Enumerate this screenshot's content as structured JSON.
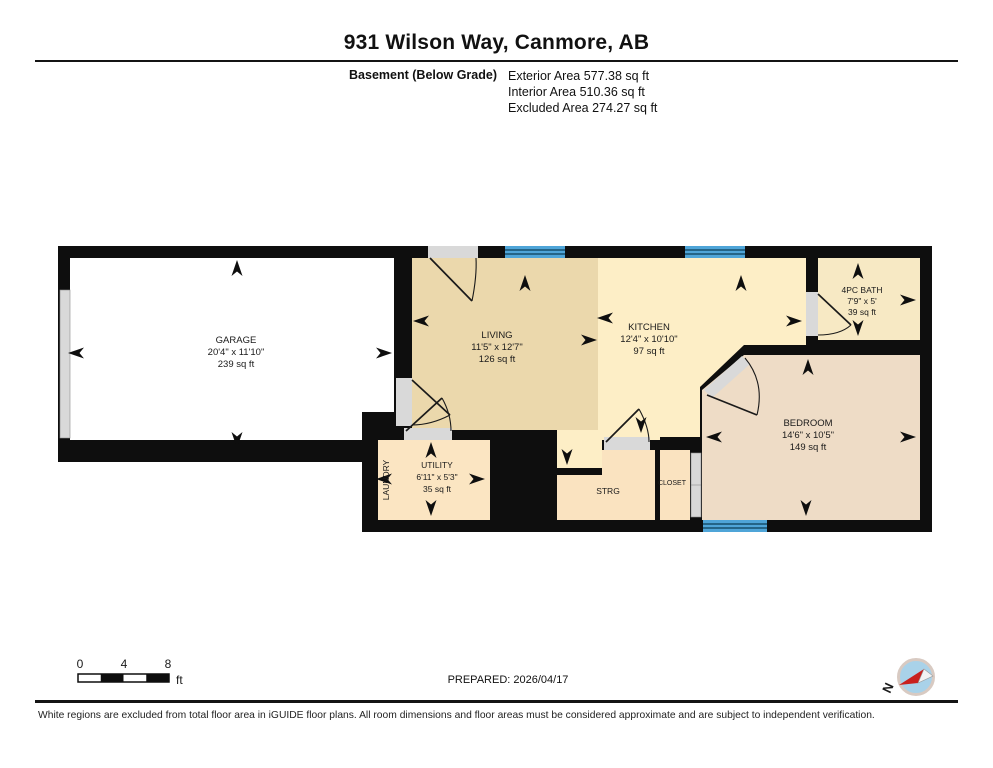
{
  "header": {
    "title": "931 Wilson Way, Canmore, AB",
    "floor_label": "Basement (Below Grade)",
    "areas": [
      "Exterior Area 577.38 sq ft",
      "Interior Area 510.36 sq ft",
      "Excluded Area 274.27 sq ft"
    ]
  },
  "rooms": {
    "garage": {
      "name": "GARAGE",
      "dims": "20'4\" x 11'10\"",
      "area": "239 sq ft"
    },
    "living": {
      "name": "LIVING",
      "dims": "11'5\" x 12'7\"",
      "area": "126 sq ft"
    },
    "kitchen": {
      "name": "KITCHEN",
      "dims": "12'4\" x 10'10\"",
      "area": "97 sq ft"
    },
    "bath": {
      "name": "4PC BATH",
      "dims": "7'9\" x 5'",
      "area": "39 sq ft"
    },
    "bedroom": {
      "name": "BEDROOM",
      "dims": "14'6\" x 10'5\"",
      "area": "149 sq ft"
    },
    "utility": {
      "name": "UTILITY",
      "dims": "6'11\" x 5'3\"",
      "area": "35 sq ft"
    },
    "laundry": {
      "name": "LAUNDRY"
    },
    "storage": {
      "name": "STRG"
    },
    "closet": {
      "name": "CLOSET"
    }
  },
  "scale_bar": {
    "ticks": [
      "0",
      "4",
      "8"
    ],
    "unit": "ft"
  },
  "footer": {
    "prepared": "PREPARED: 2026/04/17",
    "compass_label": "N",
    "disclaimer": "White regions are excluded from total floor area in iGUIDE floor plans. All room dimensions and floor areas must be considered approximate and are subject to independent verification."
  },
  "colors": {
    "wall": "#0e0e0e",
    "excluded": "#ffffff",
    "living": "#ebd8ac",
    "kitchen": "#fdeec6",
    "bath": "#f7e9c4",
    "bedroom": "#eedcc6",
    "utility": "#fbe5c2",
    "storage": "#fae3c0",
    "closet": "#fae3c0",
    "window": "#4fa5d8",
    "door": "#d9d9d9"
  }
}
